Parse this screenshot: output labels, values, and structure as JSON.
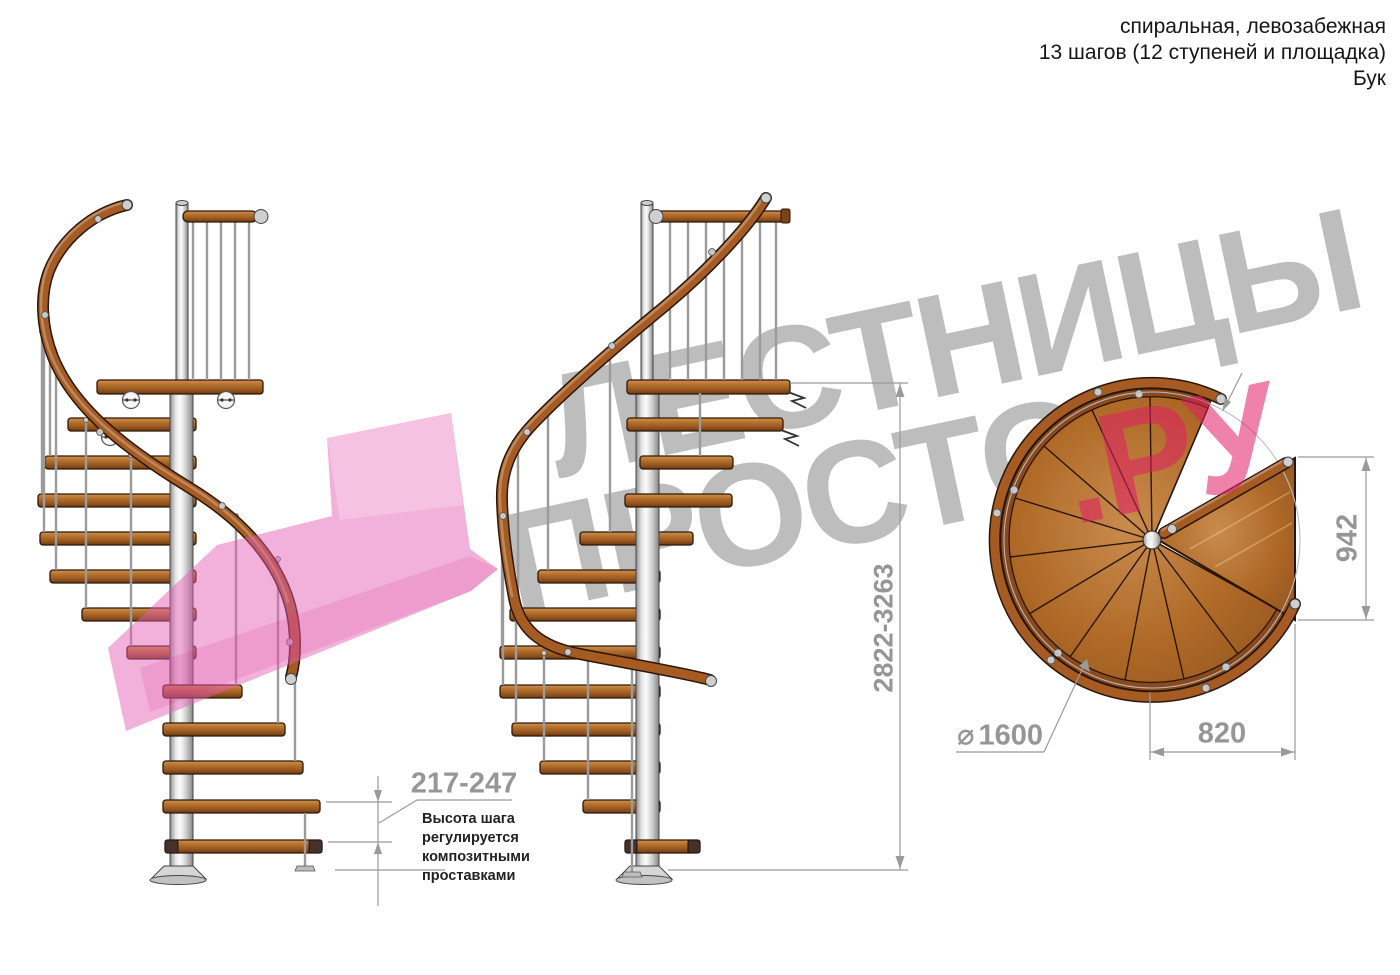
{
  "header": {
    "line1": "спиральная, левозабежная",
    "line2": "13 шагов (12 ступеней и площадка)",
    "line3": "Бук"
  },
  "watermark": {
    "word1": "ЛЕСТНИЦЫ",
    "word2": "ПРОСТО",
    "word2_suffix": ".РУ"
  },
  "dimensions": {
    "step_height": {
      "value": "217-247",
      "note": "Высота шага\nрегулируется\nкомпозитными\nпроставками"
    },
    "total_height": {
      "value": "2822-3263"
    },
    "platform_depth": {
      "value": "942"
    },
    "platform_width": {
      "value": "820"
    },
    "diameter": {
      "symbol": "⌀",
      "value": "1600"
    }
  },
  "colors": {
    "wood": "#b4702c",
    "wood_dark": "#6b3a10",
    "pole_metal": "#d9d9d9",
    "dimension_gray": "#969696",
    "watermark_gray": "#6d6d6d",
    "accent_pink": "#e01c64"
  }
}
